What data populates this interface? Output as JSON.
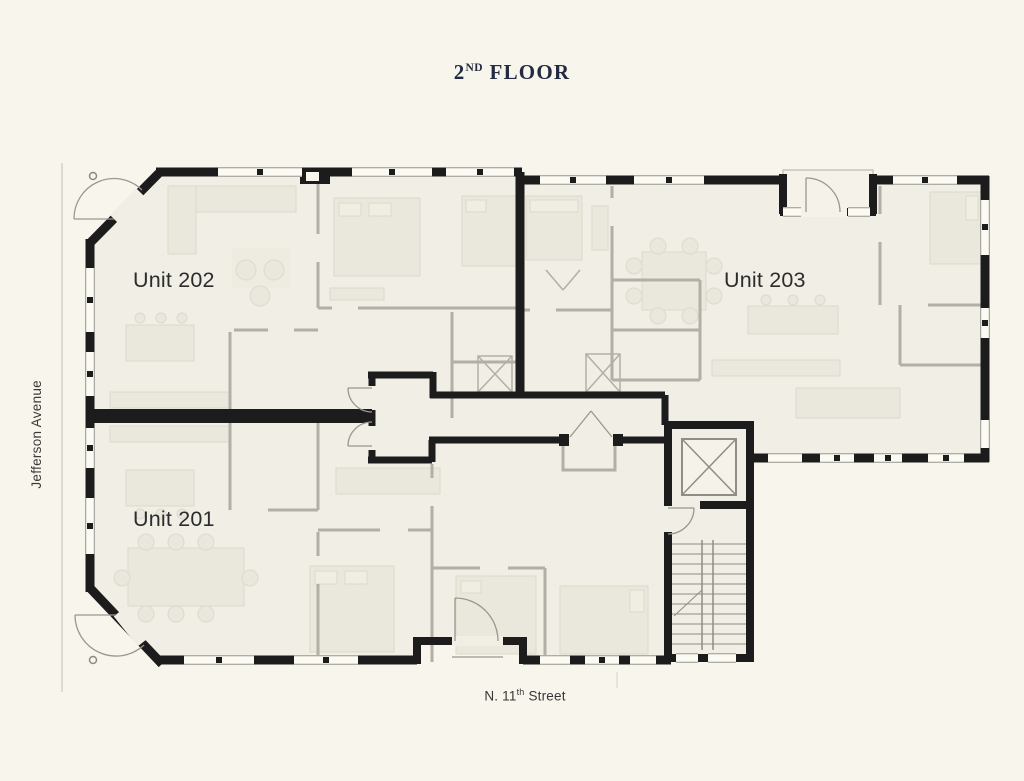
{
  "title": {
    "number": "2",
    "ordinal": "ND",
    "word": " FLOOR"
  },
  "plan": {
    "units": [
      {
        "id": "unit-202",
        "label": "Unit 202"
      },
      {
        "id": "unit-203",
        "label": "Unit 203"
      },
      {
        "id": "unit-201",
        "label": "Unit 201"
      }
    ]
  },
  "streets": {
    "west": "Jefferson Avenue",
    "south": {
      "prefix": "N. 11",
      "ordinal": "th",
      "suffix": " Street"
    }
  },
  "colors": {
    "background": "#f8f6ec",
    "floor": "#f1eee5",
    "exterior_wall": "#1c1c1c",
    "partition": "#b2afa5",
    "furniture": "#eae7dc",
    "title_text": "#232b42",
    "label_text": "#2c2c2c",
    "street_text": "#3a3a3a"
  }
}
